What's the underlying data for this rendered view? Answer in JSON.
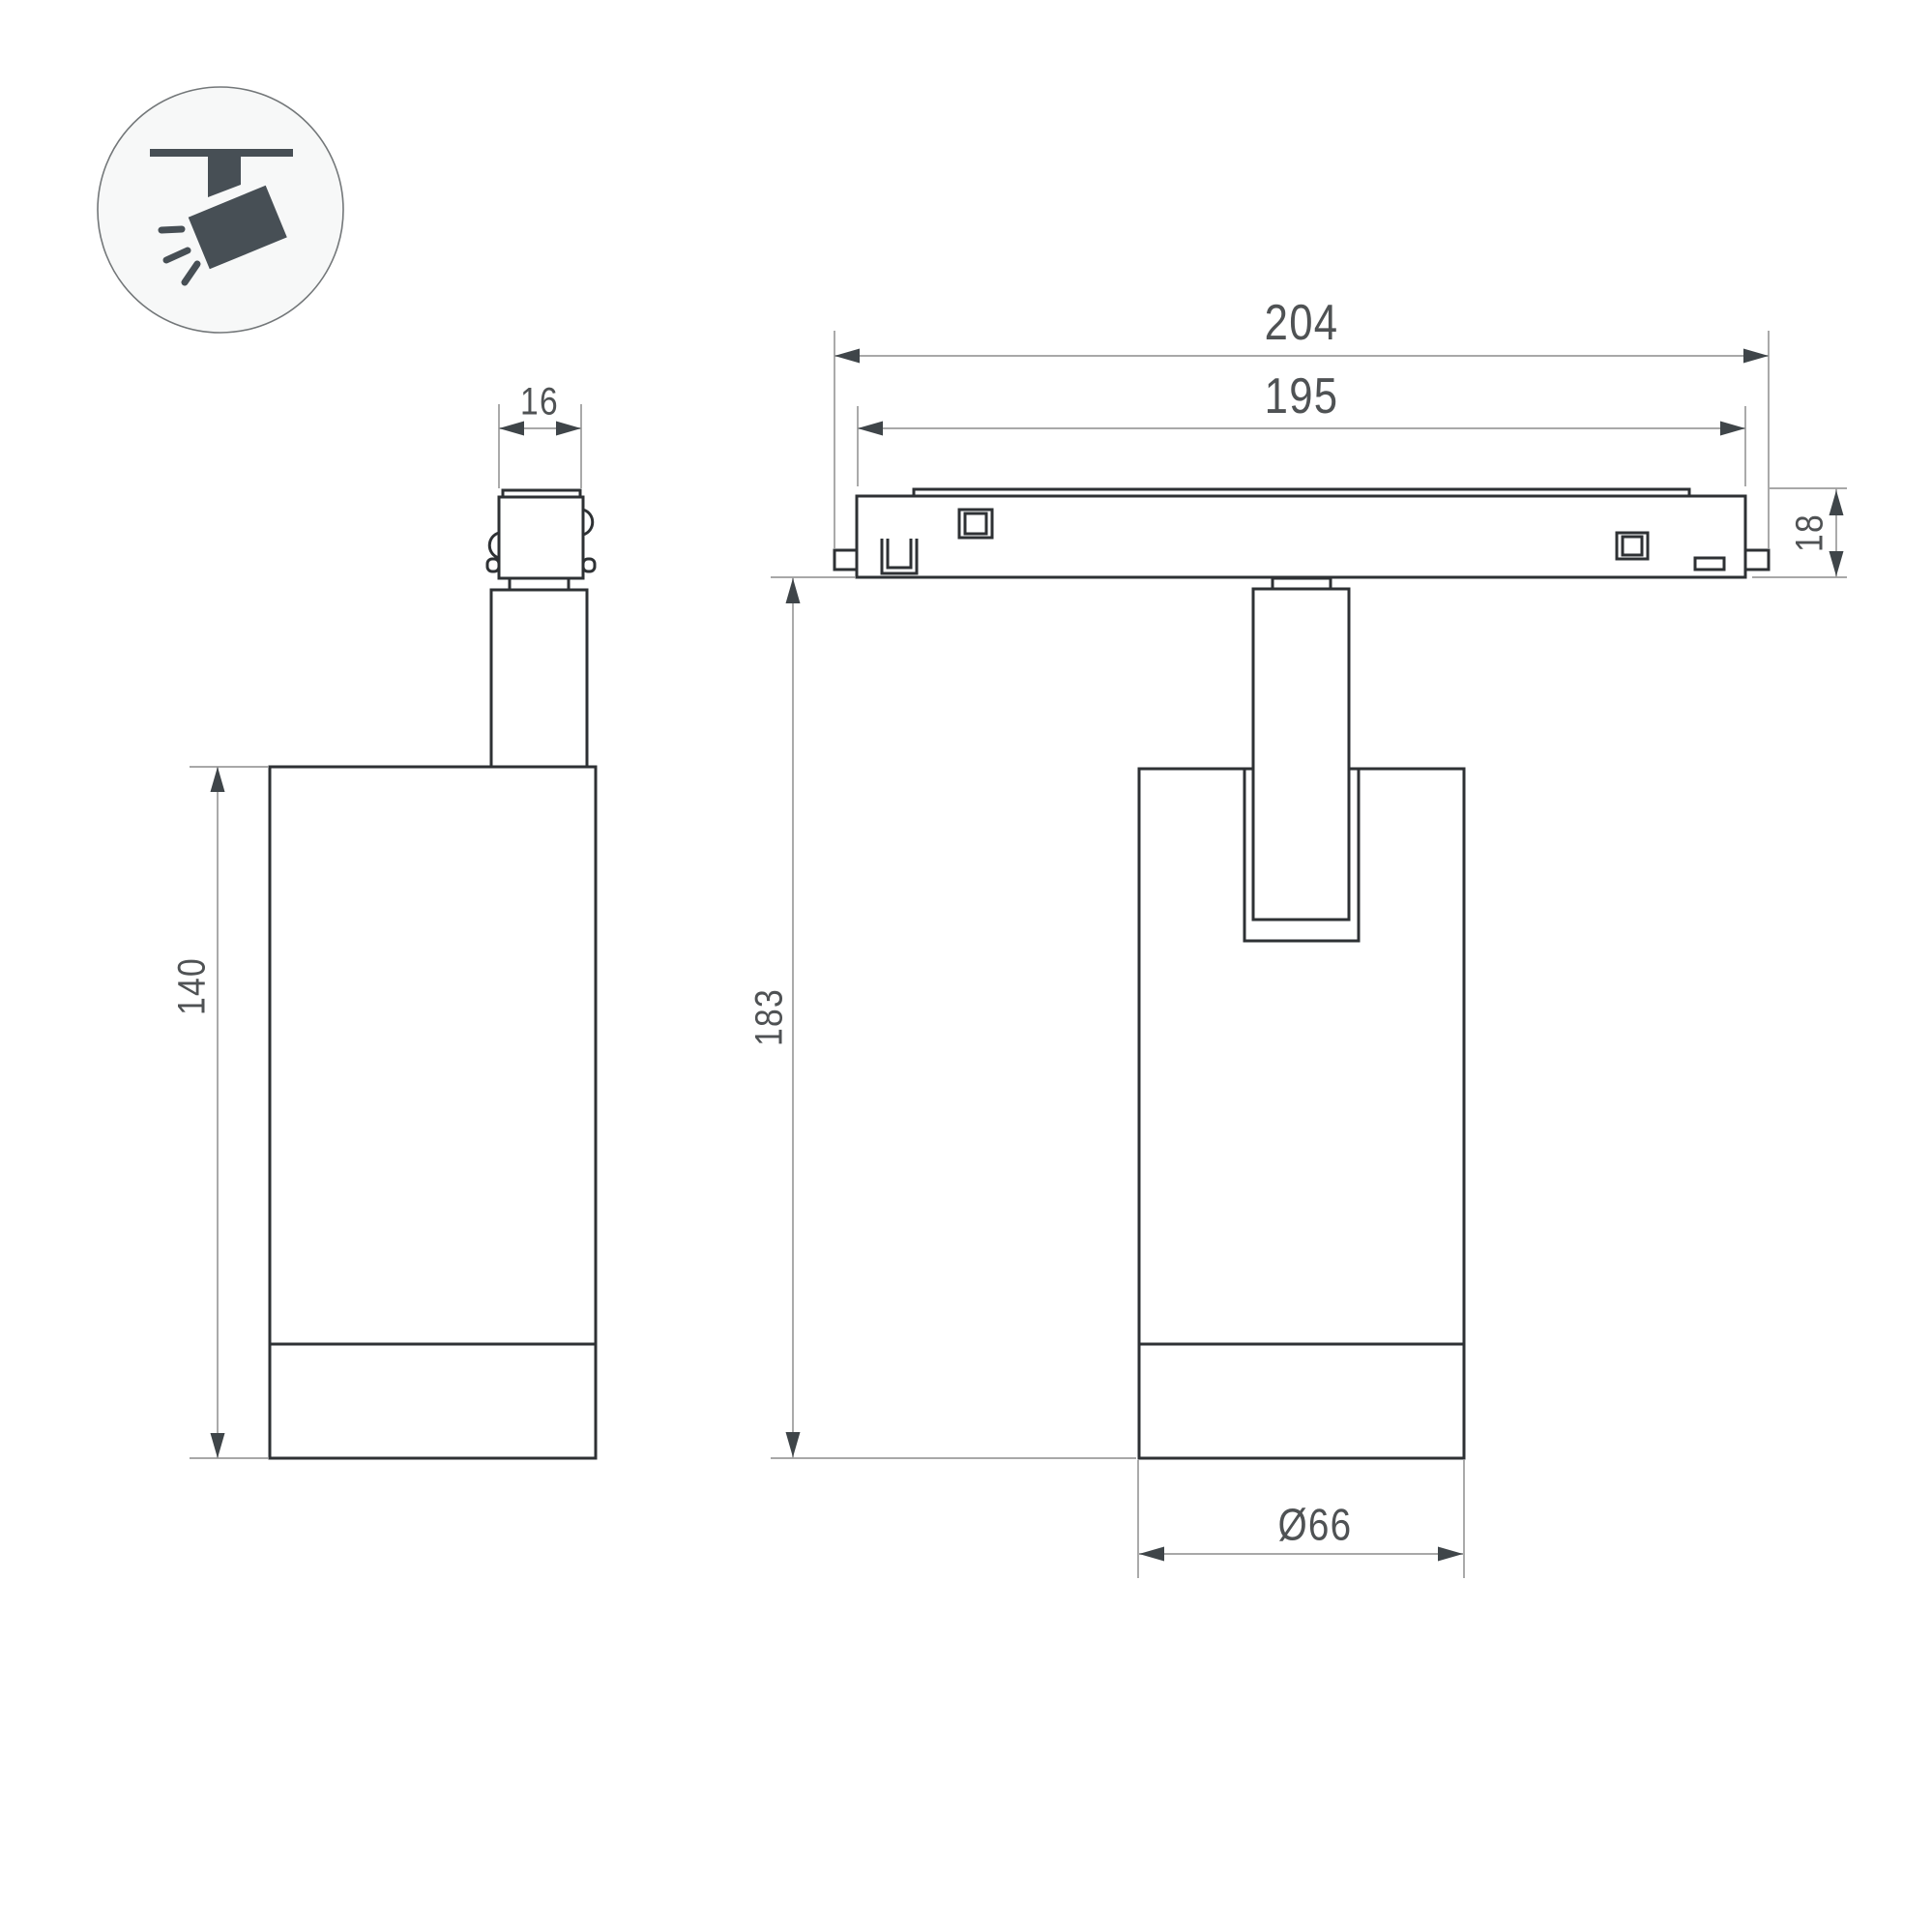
{
  "drawing": {
    "icon": {
      "name": "ceiling-spotlight-icon"
    },
    "dimensions": {
      "adapter_width": "16",
      "body_height": "140",
      "overall_length": "204",
      "track_length": "195",
      "track_height": "18",
      "total_height": "183",
      "body_diameter": "Ø66"
    },
    "colors": {
      "background": "#ffffff",
      "object_line": "#2e3134",
      "dimension_line": "#9b9b9b",
      "arrow": "#3f4549",
      "dim_text": "#4f5254",
      "icon": "#474f55",
      "icon_circle_stroke": "#737779",
      "icon_circle_fill": "#f7f8f8"
    }
  }
}
